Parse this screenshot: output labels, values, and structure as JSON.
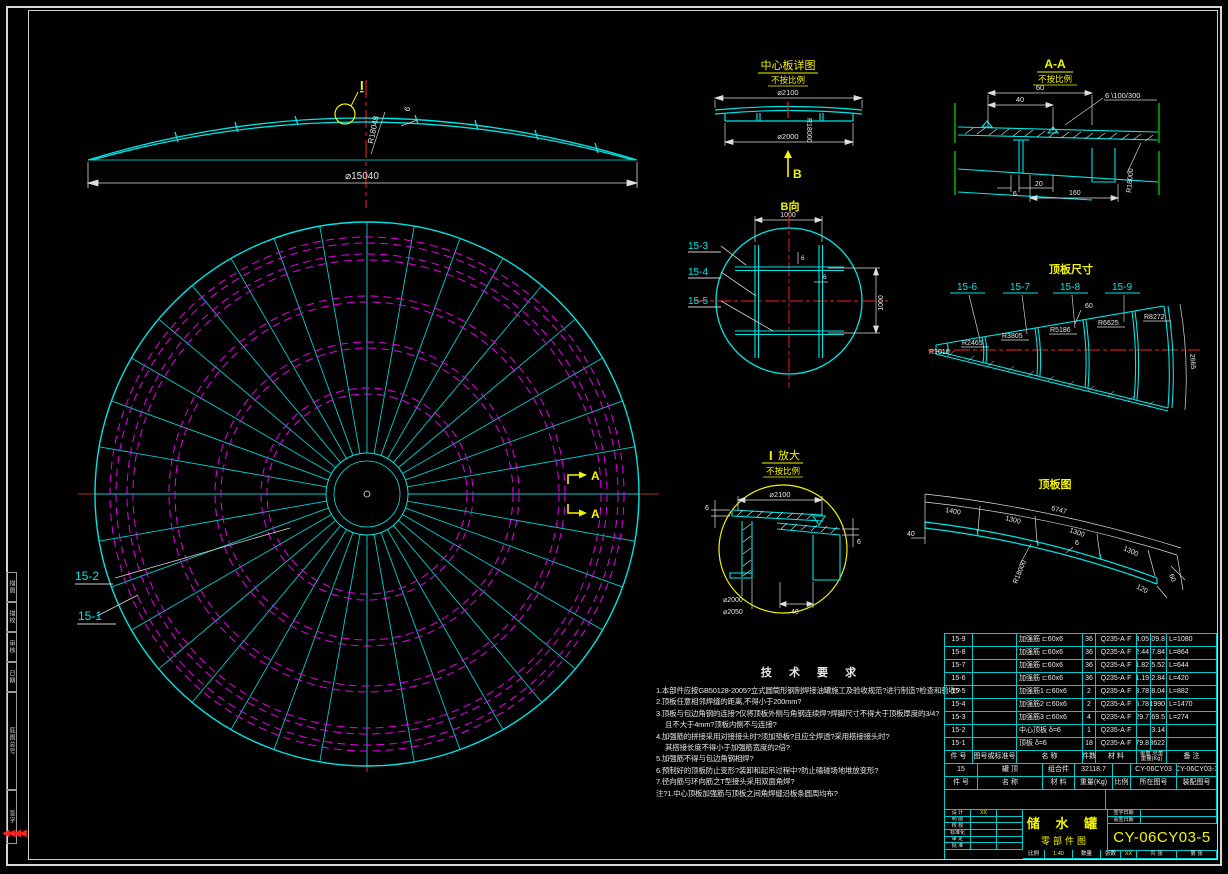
{
  "elev": {
    "mark": "I",
    "dia": "⌀15040",
    "radius": "R18048",
    "thk": "6"
  },
  "plan": {
    "label_15_1": "15-1",
    "label_15_2": "15-2",
    "section": "A"
  },
  "center_plate": {
    "title": "中心板详图",
    "scale_note": "不按比例",
    "d_outer": "⌀2100",
    "d_inner": "⌀2000",
    "radius": "R18000",
    "mark": "B"
  },
  "b_view": {
    "title": "B向",
    "dim_top": "1000",
    "dim_right": "1000",
    "t1": "6",
    "t2": "6",
    "l3": "15-3",
    "l4": "15-4",
    "l5": "15-5"
  },
  "aa": {
    "title": "A-A",
    "scale_note": "不按比例",
    "d60": "60",
    "d40": "40",
    "weld": "6 \\100/300",
    "d6": "6",
    "d20": "20",
    "d160": "160",
    "radius": "R18000"
  },
  "pdims": {
    "title": "顶板尺寸",
    "l6": "15-6",
    "l7": "15-7",
    "l8": "15-8",
    "l9": "15-9",
    "r1": "R1010",
    "r2": "R2465",
    "r3": "R3805",
    "r4": "R5186",
    "r5": "R6625",
    "r6": "R8272",
    "d60": "60",
    "arc": "2665"
  },
  "detail_i": {
    "mark": "I",
    "title": "放大",
    "scale_note": "不按比例",
    "d2100": "⌀2100",
    "t_left": "6",
    "t_right": "6",
    "d2000": "⌀2000",
    "d2050": "⌀2050",
    "d40": "40"
  },
  "pview": {
    "title": "顶板图",
    "d40": "40",
    "s1": "1400",
    "s2": "1300",
    "total": "6747",
    "s3": "1300",
    "s4": "1300",
    "d6": "6",
    "d120": "120",
    "d60": "60",
    "radius": "R18000"
  },
  "tech": {
    "title": "技 术 要 求",
    "lines": [
      "1.本部件应按GB50128-2005?立式圆筒形钢制焊接油罐施工及验收规范?进行制造?检查和验收?",
      "2.顶板任意相邻焊缝的距离,不得小于200mm?",
      "3.顶板与包边角钢的连接?仅将顶板外侧与角钢连续焊?焊脚尺寸不得大于顶板厚度的3/4?",
      "且不大于4mm?顶板内侧不与连接?",
      "4.加强筋的拼接采用对接接头时?须加垫板?且应全焊透?采用搭接接头时?",
      "其搭接长度不得小于加强筋宽度的2倍?",
      "5.加强筋不得与包边角钢相焊?",
      "6.预制好的顶板防止变形?装卸和起吊过程中?防止磕碰场地堆放变形?",
      "7.径向筋与环向筋之T型接头采用双面角焊?",
      "注?1.中心顶板加强筋与顶板之间角焊缝沿板条圆周均布?"
    ]
  },
  "table": {
    "rows": [
      {
        "id": "15-9",
        "std": "",
        "name": "加强筋 ⊏60x6",
        "qty": "36",
        "mat": "Q235-A·F",
        "unit": "3.05",
        "total": "109.8",
        "note": "L=1080"
      },
      {
        "id": "15-8",
        "std": "",
        "name": "加强筋 ⊏60x6",
        "qty": "36",
        "mat": "Q235-A·F",
        "unit": "2.44",
        "total": "87.84",
        "note": "L=864"
      },
      {
        "id": "15-7",
        "std": "",
        "name": "加强筋 ⊏60x6",
        "qty": "36",
        "mat": "Q235-A·F",
        "unit": "1.82",
        "total": "65.52",
        "note": "L=644"
      },
      {
        "id": "15-6",
        "std": "",
        "name": "加强筋 ⊏60x6",
        "qty": "36",
        "mat": "Q235-A·F",
        "unit": "1.19",
        "total": "42.84",
        "note": "L=420"
      },
      {
        "id": "15-5",
        "std": "",
        "name": "加强筋1 ⊏60x6",
        "qty": "2",
        "mat": "Q235-A·F",
        "unit": "3.78",
        "total": "8.04",
        "note": "L=882"
      },
      {
        "id": "15-4",
        "std": "",
        "name": "加强筋2 ⊏60x6",
        "qty": "2",
        "mat": "Q235-A·F",
        "unit": "296.78",
        "total": "1990",
        "note": "L=1470"
      },
      {
        "id": "15-3",
        "std": "",
        "name": "加强筋3 ⊏60x6",
        "qty": "4",
        "mat": "Q235-A·F",
        "unit": "529.7",
        "total": "969.5",
        "note": "L=274"
      },
      {
        "id": "15-2",
        "std": "",
        "name": "中心顶板 δ=6",
        "qty": "1",
        "mat": "Q235-A·F",
        "unit": "",
        "total": "163.14",
        "note": ""
      },
      {
        "id": "15-1",
        "std": "",
        "name": "顶板 δ=6",
        "qty": "18",
        "mat": "Q235-A·F",
        "unit": "479.8",
        "total": "8622",
        "note": ""
      }
    ],
    "header_a": {
      "id": "件 号",
      "std": "图号或标准号",
      "name": "名    称",
      "qty": "件数",
      "mat": "材 料",
      "w_top": "单重 总重",
      "w_bottom": "重量(Kg)",
      "note": "备 注"
    },
    "assembly": {
      "id": "15",
      "name": "罐  顶",
      "mat": "组合件",
      "weight": "32118.7",
      "scale": "",
      "loc": "CY-06CY03",
      "asm": "CY-06CY03-1"
    },
    "header_b": {
      "id": "件 号",
      "name": "名  称",
      "mat": "材  料",
      "weight": "重量(Kg)",
      "scale": "比例",
      "loc": "所在图号",
      "asm": "装配图号"
    }
  },
  "tblock": {
    "sign_rows": [
      {
        "l": "设 计",
        "v": "XX"
      },
      {
        "l": "制 图",
        "v": ""
      },
      {
        "l": "校 核",
        "v": ""
      },
      {
        "l": "标准化",
        "v": ""
      },
      {
        "l": "审 定",
        "v": ""
      },
      {
        "l": "批 准",
        "v": ""
      }
    ],
    "sig1": "签字日期",
    "sig2": "会签日期",
    "product": "储 水 罐",
    "doc": "零部件图",
    "number": "CY-06CY03-5",
    "b_scale_l": "比例",
    "b_scale_v": "1:40",
    "b_qty_l": "数量",
    "b_sheet_l": "张数",
    "b_sheet_v": "XX",
    "b_total": "共 张",
    "b_page": "第 张"
  },
  "margin": {
    "c1": "描图",
    "c2": "描校",
    "c3": "审核",
    "c4": "日期",
    "tall": "底图总号",
    "bottom": "签字"
  }
}
